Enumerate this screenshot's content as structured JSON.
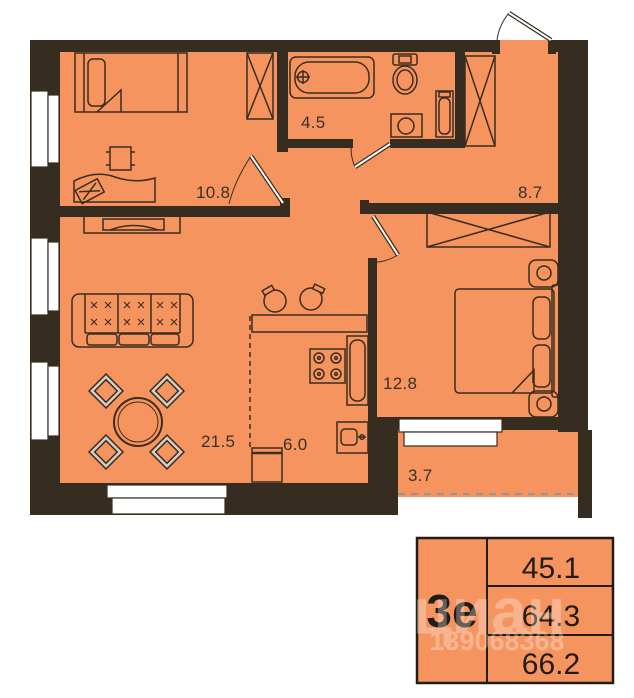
{
  "plan": {
    "rooms": [
      {
        "id": "bedroom-1",
        "area": "10.8"
      },
      {
        "id": "bathroom",
        "area": "4.5"
      },
      {
        "id": "hallway",
        "area": "8.7"
      },
      {
        "id": "living-room",
        "area": "21.5"
      },
      {
        "id": "kitchen",
        "area": "6.0"
      },
      {
        "id": "bedroom-2",
        "area": "12.8"
      },
      {
        "id": "balcony",
        "area": "3.7"
      }
    ],
    "colors": {
      "floor_orange": "#F6945F",
      "wall_brown": "#362C20",
      "outline_brown": "#3A2D1E",
      "table_border": "#211C15",
      "chair_gray": "#D7CFC7"
    }
  },
  "summary_table": {
    "type_label": "3е",
    "rows": [
      "45.1",
      "64.3",
      "66.2"
    ]
  },
  "watermark": {
    "brand": "циан",
    "id_number": "139068368"
  }
}
